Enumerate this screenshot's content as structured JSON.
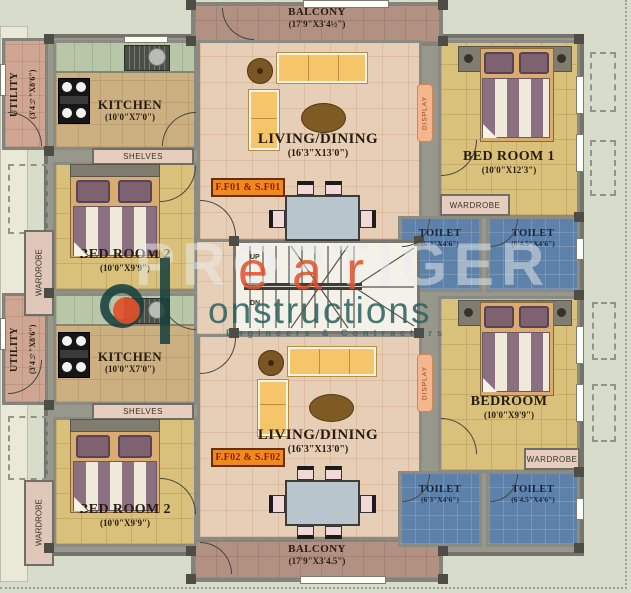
{
  "watermark": {
    "background_text": "PROPTIGER",
    "brand_part1": "ear",
    "brand_part2": "onstructions",
    "tagline": "Engineers & Contractors",
    "brand_orange": "#e0512c",
    "brand_teal": "#2a615e"
  },
  "balcony_top": {
    "name": "BALCONY",
    "dims": "(17'9\"X3'4½\")"
  },
  "balcony_bottom": {
    "name": "BALCONY",
    "dims": "(17'9\"X3'4.5\")"
  },
  "stairs": {
    "up": "UP",
    "down": "DN"
  },
  "unit1": {
    "flat_badge": "F.F01 & S.F01",
    "badge_color": "#ef8b1c",
    "utility": {
      "name": "UTILITY",
      "dims": "(3'4½\"X8'6\")"
    },
    "kitchen": {
      "name": "KITCHEN",
      "dims": "(10'0\"X7'0\")"
    },
    "shelves": "SHELVES",
    "bedroom_left": {
      "name": "BED ROOM 2",
      "dims": "(10'0\"X9'9\")"
    },
    "living": {
      "name": "LIVING/DINING",
      "dims": "(16'3\"X13'0\")"
    },
    "bedroom_right": {
      "name": "BED ROOM 1",
      "dims": "(10'0\"X12'3\")"
    },
    "toilet_left": {
      "name": "TOILET",
      "dims": "(6'3\"X4'6\")"
    },
    "toilet_right": {
      "name": "TOILET",
      "dims": "(6'4.5\"X4'6\")"
    },
    "wardrobe_side": "WARDROBE",
    "wardrobe_top": "WARDROBE",
    "display": "DISPLAY"
  },
  "unit2": {
    "flat_badge": "F.F02 & S.F02",
    "utility": {
      "name": "UTILITY",
      "dims": "(3'4½\"X8'6\")"
    },
    "kitchen": {
      "name": "KITCHEN",
      "dims": "(10'0\"X7'0\")"
    },
    "shelves": "SHELVES",
    "bedroom_left": {
      "name": "BED ROOM 2",
      "dims": "(10'0\"X9'9\")"
    },
    "living": {
      "name": "LIVING/DINING",
      "dims": "(16'3\"X13'0\")"
    },
    "bedroom_right": {
      "name": "BEDROOM",
      "dims": "(10'0\"X9'9\")"
    },
    "toilet_left": {
      "name": "TOILET",
      "dims": "(6'3\"X4'6\")"
    },
    "toilet_right": {
      "name": "TOILET",
      "dims": "(6'4.5\"X4'6\")"
    },
    "wardrobe_side": "WARDROBE",
    "wardrobe_top": "WARDROBE",
    "display": "DISPLAY"
  }
}
